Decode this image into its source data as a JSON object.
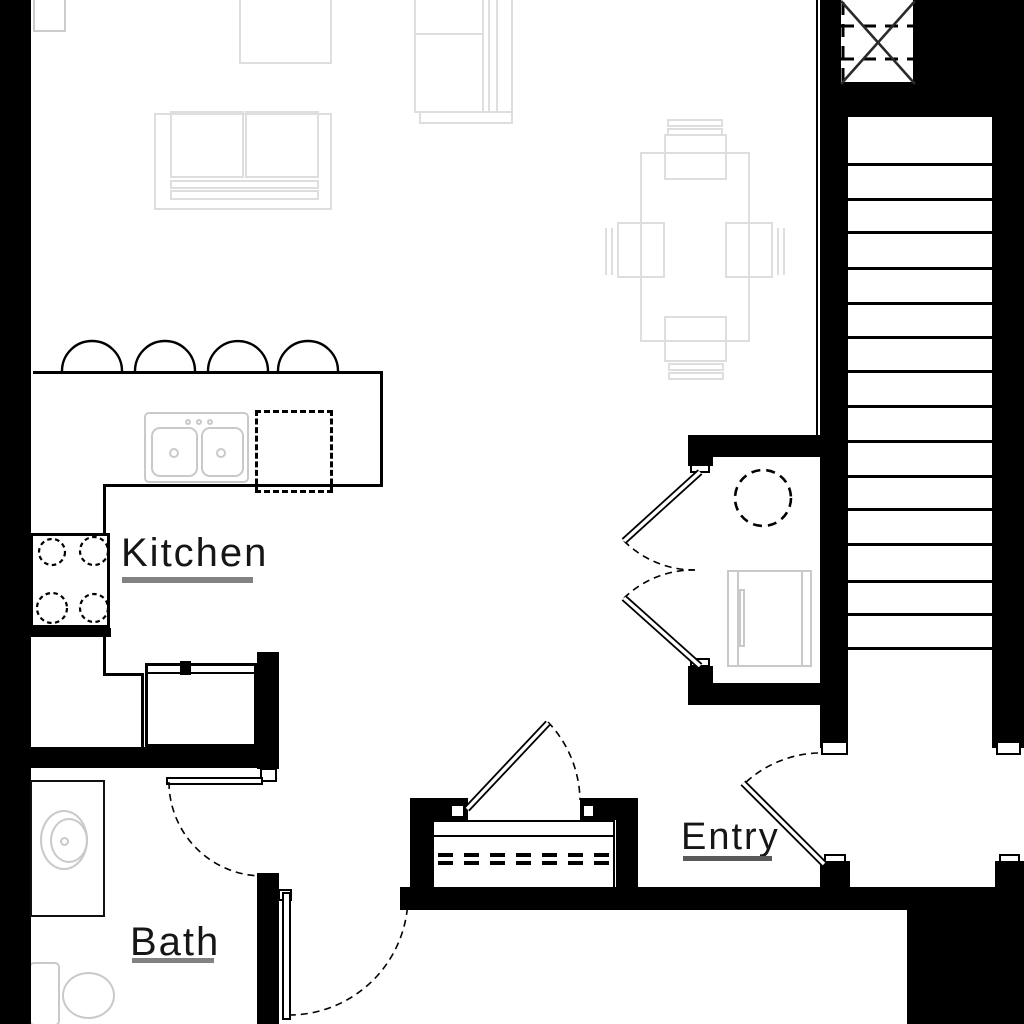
{
  "title": "Apartment unit floor plan",
  "rooms": {
    "kitchen": {
      "label": "Kitchen"
    },
    "bath": {
      "label": "Bath"
    },
    "entry": {
      "label": "Entry"
    }
  },
  "colors": {
    "wall": "#000000",
    "furniture_outline": "#dedede",
    "fixture_outline": "#c9c9c9",
    "label_text": "#161616",
    "kitchen_underline": "#828282",
    "bath_underline": "#828282",
    "entry_underline": "#5a5a5a"
  },
  "stairs": {
    "tread_lines": 15
  },
  "fixtures": [
    "stairs",
    "shaft-x-symbol",
    "kitchen-sink",
    "dishwasher",
    "stove-burners",
    "refrigerator",
    "bar-stool-arcs",
    "sofa",
    "armchair",
    "side-table",
    "dining-table",
    "dining-chairs",
    "water-heater",
    "utility-appliance",
    "vanity-sink",
    "toilet",
    "entry-closet-shelf",
    "door-swings"
  ]
}
